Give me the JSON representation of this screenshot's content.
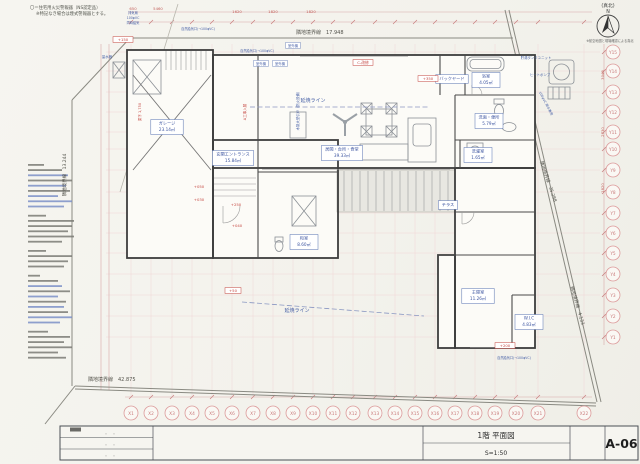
{
  "header": {
    "fire_note1": "〇＝住宅用火災警報器（NS認定品）",
    "fire_note2": "※特記なき場合は煙式警報器とする。"
  },
  "compass": {
    "label": "(真北)",
    "n": "N",
    "note": "※航空地図と現場確認による真北"
  },
  "boundaries": {
    "top": "隣地境界線　17.948",
    "bottom": "隣地境界線　42.875",
    "left": "隣地境界線　13.244",
    "right_long": "隣地境界線　35.288",
    "right_short": "隣地境界線　4.133"
  },
  "grid": {
    "x": [
      "X1",
      "X2",
      "X3",
      "X4",
      "X5",
      "X6",
      "X7",
      "X8",
      "X9",
      "X10",
      "X11",
      "X12",
      "X13",
      "X14",
      "X15",
      "X16",
      "X17",
      "X18",
      "X19",
      "X20",
      "X21",
      "X22"
    ],
    "y": [
      "Y15",
      "Y14",
      "Y13",
      "Y12",
      "Y11",
      "Y10",
      "Y9",
      "Y8",
      "Y7",
      "Y6",
      "Y5",
      "Y4",
      "Y3",
      "Y2",
      "Y1"
    ]
  },
  "dims": {
    "top": [
      "650",
      "5460",
      "1620",
      "1820",
      "1820"
    ],
    "right": [
      "3048",
      "2730",
      "1820"
    ]
  },
  "rooms": {
    "garage": {
      "name": "ガレージ",
      "area": "23.14㎡"
    },
    "entrance": {
      "name": "玄関エントランス",
      "area": "15.84㎡"
    },
    "ldk": {
      "name": "居間・台所・食堂",
      "area": "39.33㎡"
    },
    "washitsu": {
      "name": "和室",
      "area": "8.60㎡"
    },
    "bath": {
      "name": "浴室",
      "area": "4.05㎡"
    },
    "backyard": {
      "name": "バックヤード",
      "area": ""
    },
    "lavatory": {
      "name": "洗面・便所",
      "area": "5.79㎡"
    },
    "laundry": {
      "name": "洗濯室",
      "area": "1.65㎡"
    },
    "bedroom": {
      "name": "主寝室",
      "area": "11.26㎡"
    },
    "wic": {
      "name": "W.I.C",
      "area": "4.83㎡"
    },
    "terrace": {
      "name": "テラス",
      "area": ""
    }
  },
  "annotations": {
    "ensho1": "延焼ライン",
    "ensho2": "延焼ライン",
    "outdoor1": "室外機",
    "outdoor2": "室外機",
    "outdoor3": "室外機",
    "kyuki1": "自然給気口(→100φVC)",
    "kyuki2": "自然給気口(→100φVC)",
    "kyuki3": "自然給気口(→100φVC)",
    "tank": "貯湯タンクユニット",
    "heatpump": "ヒートポンプ",
    "meter": "量水器",
    "rain": "100φVC 雨水兼用",
    "wood_door": "木製大型引戸（防火設備）",
    "exhaust1": "排気扇",
    "exhaust2": "100φVC",
    "exhaust3": "同時給気"
  },
  "levels": [
    "+150",
    "+350",
    "C-改修",
    "+250",
    "+050",
    "+030",
    "+040",
    "+50",
    "+200"
  ],
  "levels_rot": [
    "梁下 1,750",
    "A工事入替"
  ],
  "notes_block": {
    "lines": [
      {
        "w": 16,
        "c": "d"
      },
      {
        "w": 34,
        "c": "d"
      },
      {
        "w": 40,
        "c": "b"
      },
      {
        "w": 44,
        "c": "d"
      },
      {
        "w": 38,
        "c": "b"
      },
      {
        "w": 42,
        "c": "d"
      },
      {
        "w": 30,
        "c": "b"
      },
      {
        "w": 44,
        "c": "b"
      },
      {
        "w": 36,
        "c": "b"
      },
      {
        "w": 18,
        "c": "d",
        "g": true
      },
      {
        "w": 46,
        "c": "d"
      },
      {
        "w": 44,
        "c": "d"
      },
      {
        "w": 40,
        "c": "d"
      },
      {
        "w": 46,
        "c": "d"
      },
      {
        "w": 34,
        "c": "d"
      },
      {
        "w": 18,
        "c": "d",
        "g": true
      },
      {
        "w": 44,
        "c": "d"
      },
      {
        "w": 40,
        "c": "d"
      },
      {
        "w": 36,
        "c": "d"
      },
      {
        "w": 12,
        "c": "d",
        "g": true
      },
      {
        "w": 30,
        "c": "d"
      },
      {
        "w": 34,
        "c": "b"
      },
      {
        "w": 42,
        "c": "d"
      },
      {
        "w": 30,
        "c": "b"
      },
      {
        "w": 38,
        "c": "d"
      },
      {
        "w": 36,
        "c": "b"
      },
      {
        "w": 40,
        "c": "d"
      },
      {
        "w": 44,
        "c": "b"
      },
      {
        "w": 32,
        "c": "b"
      },
      {
        "w": 20,
        "c": "d",
        "g": true
      },
      {
        "w": 42,
        "c": "d"
      },
      {
        "w": 36,
        "c": "d"
      },
      {
        "w": 44,
        "c": "d"
      },
      {
        "w": 30,
        "c": "d"
      },
      {
        "w": 38,
        "c": "d"
      }
    ]
  },
  "titleblock": {
    "title": "1階 平面図",
    "scale": "S=1:50",
    "number": "A-06",
    "rev_dots": "・　・"
  }
}
